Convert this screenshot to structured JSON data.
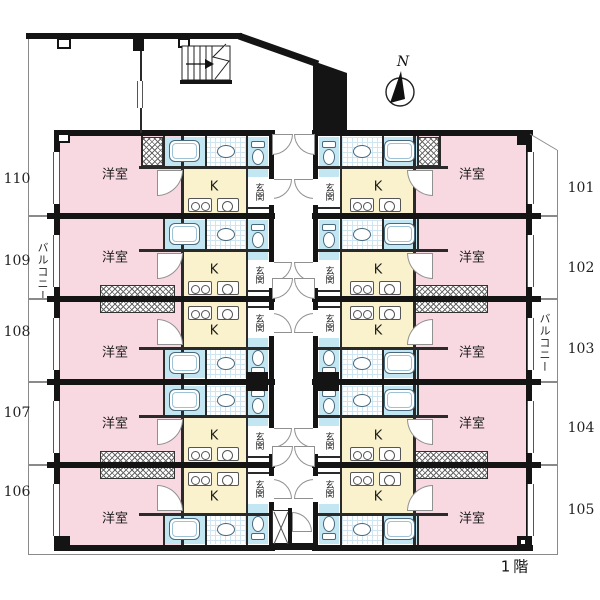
{
  "floor_plan": {
    "floor_label": "1階",
    "compass": {
      "label": "N",
      "icon": "compass-north-icon"
    },
    "balcony_left_label": "バルコニー",
    "balcony_right_label": "バルコニー",
    "room_labels": {
      "western_room": "洋室",
      "kitchen": "K",
      "entrance": "玄関"
    },
    "units": [
      {
        "number": "110",
        "column": "left",
        "row": 1,
        "plumbing": "top"
      },
      {
        "number": "109",
        "column": "left",
        "row": 2,
        "plumbing": "top"
      },
      {
        "number": "108",
        "column": "left",
        "row": 3,
        "plumbing": "bottom"
      },
      {
        "number": "107",
        "column": "left",
        "row": 4,
        "plumbing": "top"
      },
      {
        "number": "106",
        "column": "left",
        "row": 5,
        "plumbing": "bottom"
      },
      {
        "number": "101",
        "column": "right",
        "row": 1,
        "plumbing": "top"
      },
      {
        "number": "102",
        "column": "right",
        "row": 2,
        "plumbing": "top"
      },
      {
        "number": "103",
        "column": "right",
        "row": 3,
        "plumbing": "bottom"
      },
      {
        "number": "104",
        "column": "right",
        "row": 4,
        "plumbing": "top"
      },
      {
        "number": "105",
        "column": "right",
        "row": 5,
        "plumbing": "bottom"
      }
    ],
    "features": [
      "stairs-icon",
      "elevator-shaft",
      "bathtub-icon",
      "toilet-icon",
      "washbasin-icon",
      "stove-icon",
      "sink-icon",
      "closet-hatch",
      "door-arc"
    ],
    "colors": {
      "room_pink": "#f8d9e2",
      "kitchen_yellow": "#faf2cc",
      "water_blue": "#c3e6f3",
      "wall_black": "#141414"
    }
  }
}
